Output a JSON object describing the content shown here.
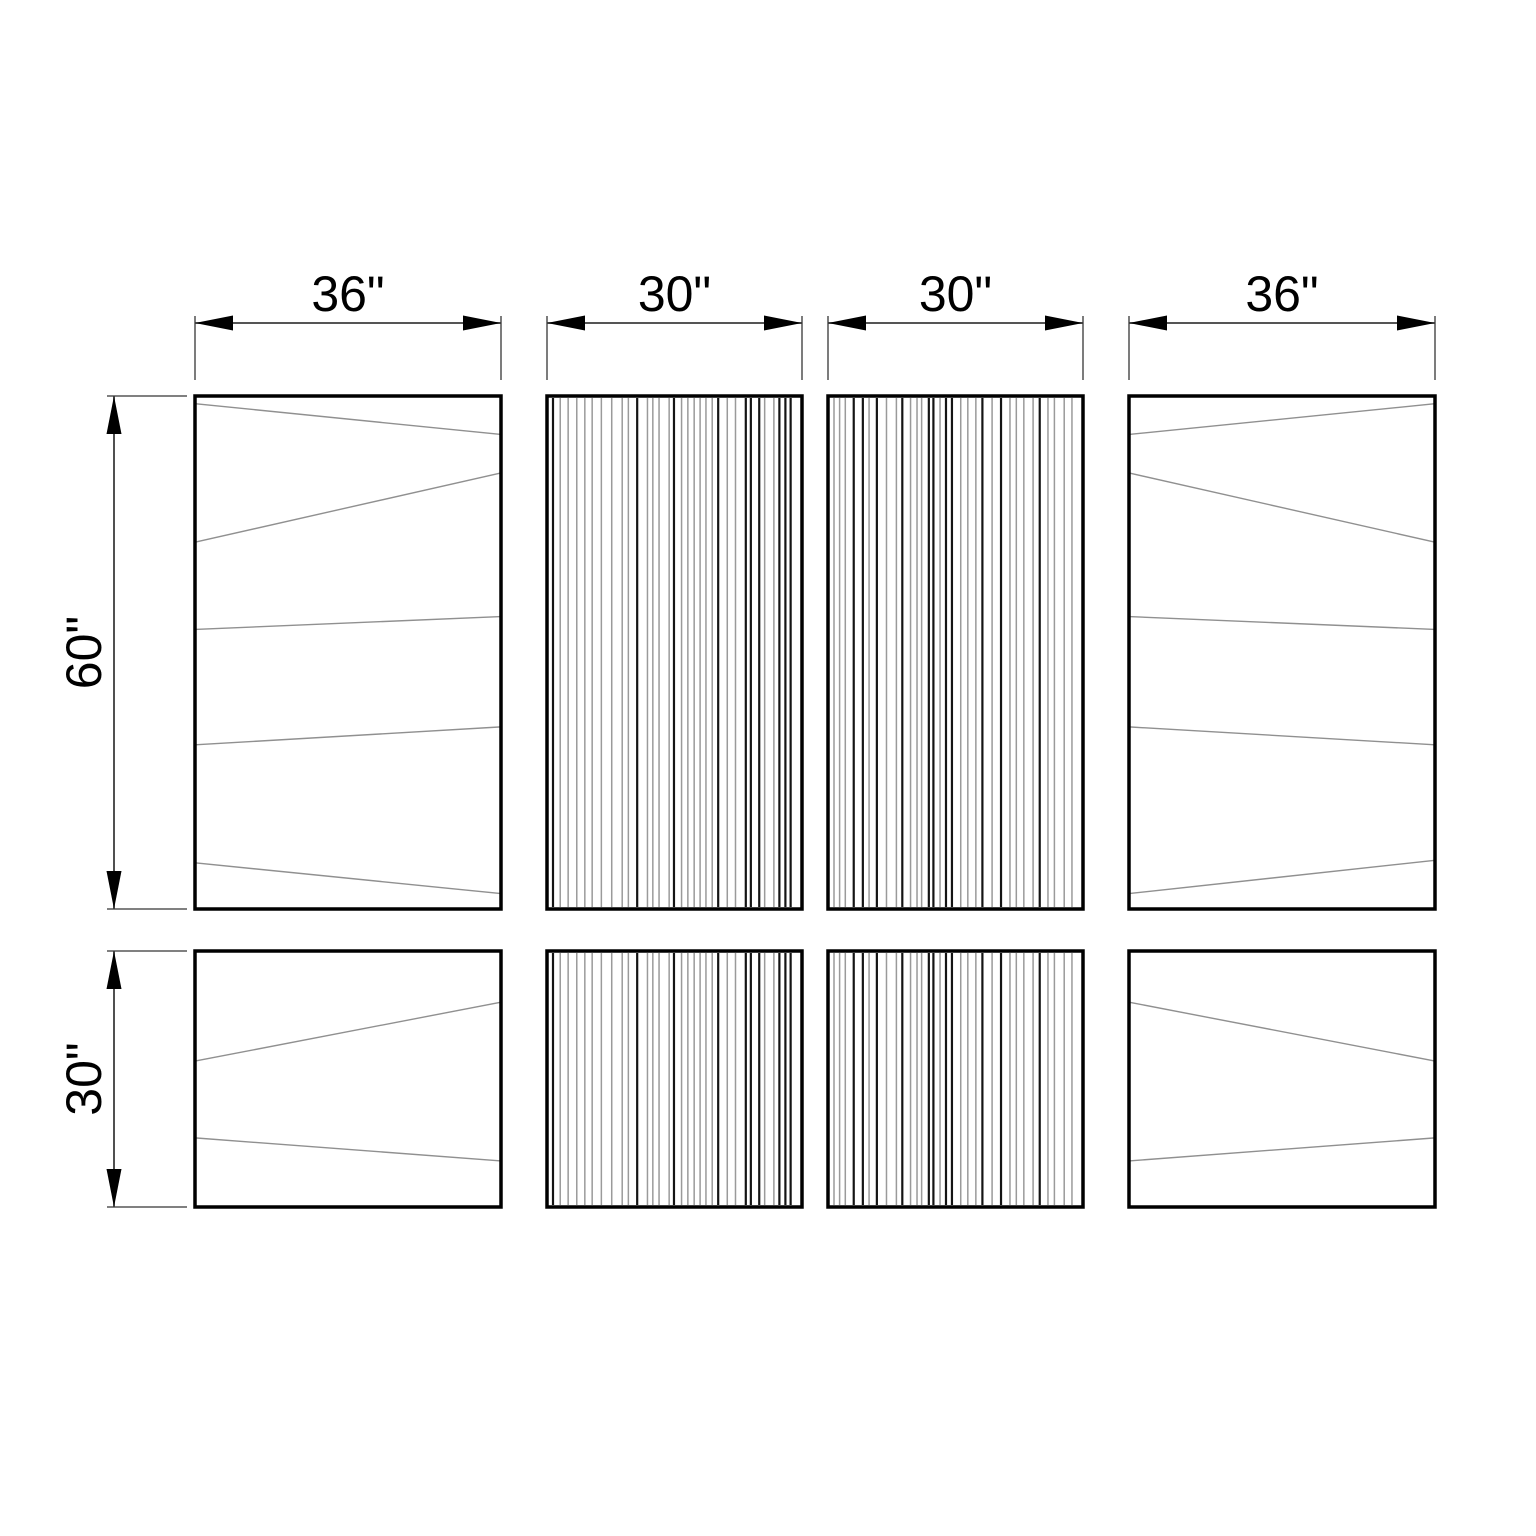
{
  "document": {
    "type": "technical-panel-drawing",
    "background": "#ffffff",
    "canvas_width": 1536,
    "canvas_height": 1536
  },
  "style": {
    "panel_border_color": "#000000",
    "panel_border_width": 3.5,
    "panel_fill": "#ffffff",
    "plank_line_color": "#909090",
    "plank_line_width": 1.4,
    "flute_dark_color": "#141414",
    "flute_dark_width": 2.2,
    "flute_light_color": "#9a9a9a",
    "flute_light_width": 1.5,
    "dim_line_color": "#3d3d3d",
    "dim_line_width": 1.8,
    "ext_line_color": "#6e6e6e",
    "ext_line_width": 1.8,
    "arrow_color": "#000000",
    "arrow_length": 38,
    "arrow_half_width": 7.5,
    "label_color": "#000000",
    "label_font_size": 50
  },
  "panels": [
    {
      "name": "panel-top-left-36x60",
      "width_in": 36,
      "height_in": 60,
      "x": 195,
      "y": 396,
      "w": 306,
      "h": 513,
      "pattern": "plank",
      "plank_lines": [
        [
          0,
          0.015,
          1,
          0.075
        ],
        [
          0,
          0.285,
          1,
          0.15
        ],
        [
          0,
          0.455,
          1,
          0.43
        ],
        [
          0,
          0.68,
          1,
          0.645
        ],
        [
          0,
          0.91,
          1,
          0.97
        ]
      ]
    },
    {
      "name": "panel-top-mid-left-30x60",
      "width_in": 30,
      "height_in": 60,
      "x": 547,
      "y": 396,
      "w": 255,
      "h": 513,
      "pattern": "fluted",
      "seed": 101
    },
    {
      "name": "panel-top-mid-right-30x60",
      "width_in": 30,
      "height_in": 60,
      "x": 828,
      "y": 396,
      "w": 255,
      "h": 513,
      "pattern": "fluted",
      "seed": 202
    },
    {
      "name": "panel-top-right-36x60",
      "width_in": 36,
      "height_in": 60,
      "x": 1129,
      "y": 396,
      "w": 306,
      "h": 513,
      "pattern": "plank",
      "plank_lines": [
        [
          0,
          0.075,
          1,
          0.015
        ],
        [
          0,
          0.15,
          1,
          0.285
        ],
        [
          0,
          0.43,
          1,
          0.455
        ],
        [
          0,
          0.645,
          1,
          0.68
        ],
        [
          0,
          0.97,
          1,
          0.905
        ]
      ]
    },
    {
      "name": "panel-bottom-left-36x30",
      "width_in": 36,
      "height_in": 30,
      "x": 195,
      "y": 951,
      "w": 306,
      "h": 256,
      "pattern": "plank",
      "plank_lines": [
        [
          0,
          0.43,
          1,
          0.2
        ],
        [
          0,
          0.73,
          1,
          0.82
        ]
      ]
    },
    {
      "name": "panel-bottom-mid-left-30x30",
      "width_in": 30,
      "height_in": 30,
      "x": 547,
      "y": 951,
      "w": 255,
      "h": 256,
      "pattern": "fluted",
      "seed": 101
    },
    {
      "name": "panel-bottom-mid-right-30x30",
      "width_in": 30,
      "height_in": 30,
      "x": 828,
      "y": 951,
      "w": 255,
      "h": 256,
      "pattern": "fluted",
      "seed": 202
    },
    {
      "name": "panel-bottom-right-36x30",
      "width_in": 36,
      "height_in": 30,
      "x": 1129,
      "y": 951,
      "w": 306,
      "h": 256,
      "pattern": "plank",
      "plank_lines": [
        [
          0,
          0.2,
          1,
          0.43
        ],
        [
          0,
          0.82,
          1,
          0.73
        ]
      ]
    }
  ],
  "dimensions": [
    {
      "name": "dim-width-panel-1",
      "label": "36\"",
      "orientation": "horizontal",
      "start": 195,
      "end": 501,
      "line": 323,
      "ext_to": 380
    },
    {
      "name": "dim-width-panel-2",
      "label": "30\"",
      "orientation": "horizontal",
      "start": 547,
      "end": 802,
      "line": 323,
      "ext_to": 380
    },
    {
      "name": "dim-width-panel-3",
      "label": "30\"",
      "orientation": "horizontal",
      "start": 828,
      "end": 1083,
      "line": 323,
      "ext_to": 380
    },
    {
      "name": "dim-width-panel-4",
      "label": "36\"",
      "orientation": "horizontal",
      "start": 1129,
      "end": 1435,
      "line": 323,
      "ext_to": 380
    },
    {
      "name": "dim-height-top-row",
      "label": "60\"",
      "orientation": "vertical",
      "start": 396,
      "end": 909,
      "line": 114,
      "ext_to": 187
    },
    {
      "name": "dim-height-bottom-row",
      "label": "30\"",
      "orientation": "vertical",
      "start": 951,
      "end": 1207,
      "line": 114,
      "ext_to": 187
    }
  ]
}
